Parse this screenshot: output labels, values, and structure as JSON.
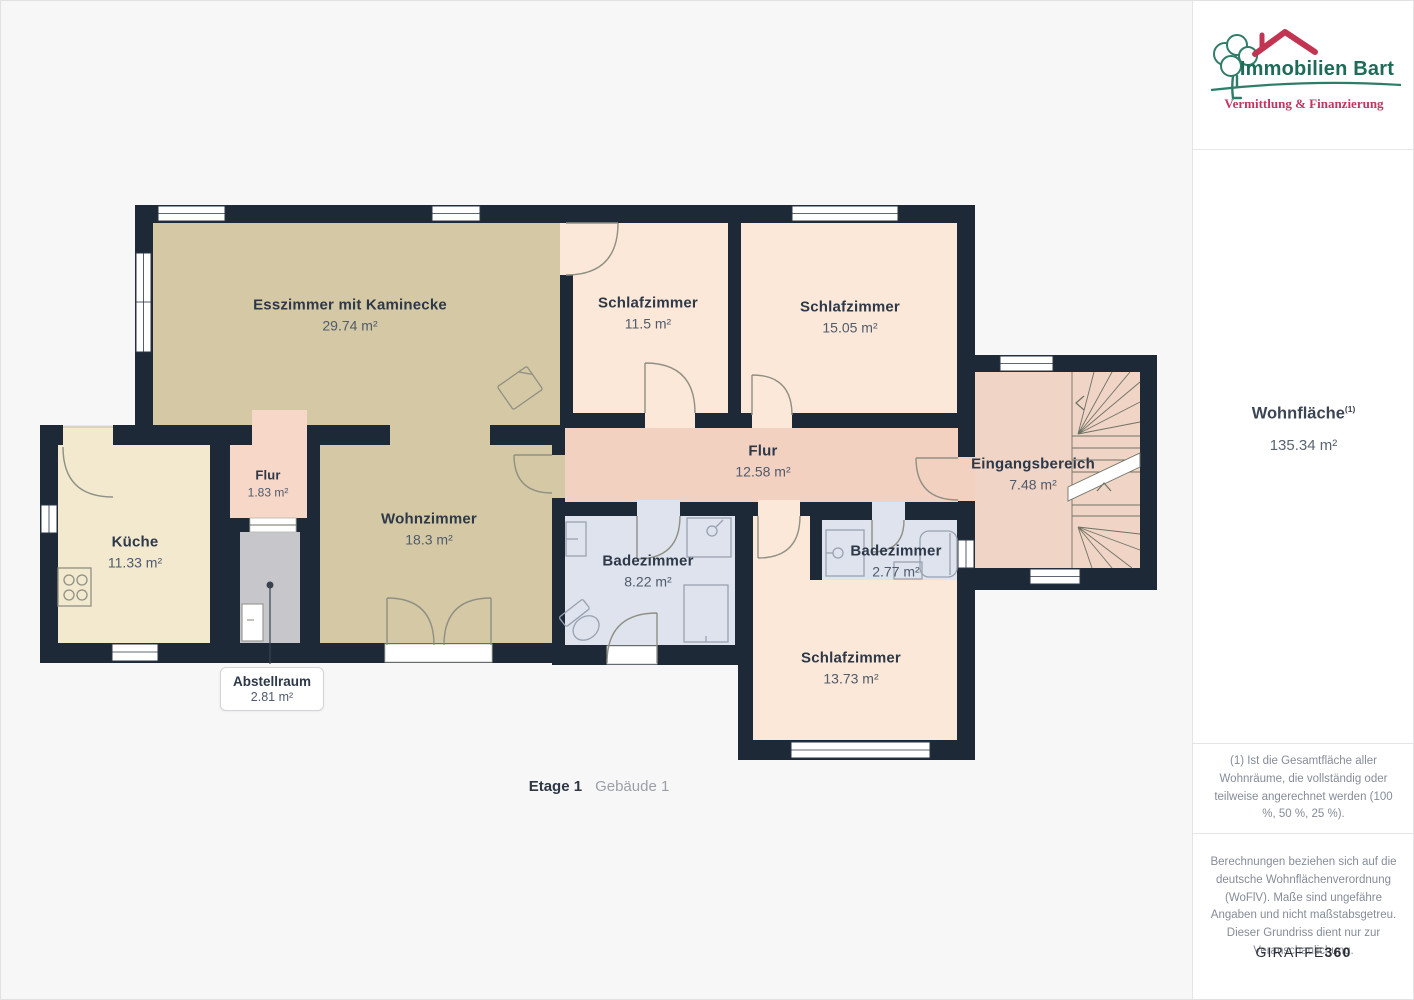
{
  "plan": {
    "caption": {
      "floor": "Etage 1",
      "building": "Gebäude 1"
    },
    "rooms": {
      "esszimmer": {
        "name": "Esszimmer mit Kaminecke",
        "area": "29.74 m²"
      },
      "schlafzimmer_1": {
        "name": "Schlafzimmer",
        "area": "11.5 m²"
      },
      "schlafzimmer_2": {
        "name": "Schlafzimmer",
        "area": "15.05 m²"
      },
      "flur": {
        "name": "Flur",
        "area": "12.58 m²"
      },
      "eingangsbereich": {
        "name": "Eingangsbereich",
        "area": "7.48 m²"
      },
      "kueche": {
        "name": "Küche",
        "area": "11.33 m²"
      },
      "flur_klein": {
        "name": "Flur",
        "area": "1.83 m²"
      },
      "wohnzimmer": {
        "name": "Wohnzimmer",
        "area": "18.3 m²"
      },
      "badezimmer_1": {
        "name": "Badezimmer",
        "area": "8.22 m²"
      },
      "badezimmer_2": {
        "name": "Badezimmer",
        "area": "2.77 m²"
      },
      "schlafzimmer_3": {
        "name": "Schlafzimmer",
        "area": "13.73 m²"
      },
      "abstellraum": {
        "name": "Abstellraum",
        "area": "2.81 m²"
      }
    },
    "colors": {
      "wall": "#1e2938",
      "dining_living": "#d5c8a4",
      "bedroom": "#fbe8d8",
      "corridor": "#f2d1c1",
      "entrance": "#f0d4c5",
      "small_hall": "#f6d7c8",
      "kitchen": "#f2e9cf",
      "bathroom": "#dee3ee",
      "storage": "#c7c7cb"
    }
  },
  "sidebar": {
    "logo": {
      "title": "Immobilien Bart",
      "subtitle": "Vermittlung & Finanzierung",
      "green": "#1d6b58",
      "red": "#c23552"
    },
    "living_area": {
      "label": "Wohnfläche",
      "superscript": "(1)",
      "value": "135.34 m²"
    },
    "footnote": "(1) Ist die Gesamtfläche aller Wohnräume, die vollständig oder teilweise angerechnet werden (100 %, 50 %, 25 %).",
    "disclaimer": "Berechnungen beziehen sich auf die deutsche Wohnflächenverordnung (WoFlV). Maße sind ungefähre Angaben und nicht maßstabsgetreu. Dieser Grundriss dient nur zur Veranschaulichung.",
    "brand": {
      "name": "GIRAFFE",
      "suffix": "360"
    }
  }
}
